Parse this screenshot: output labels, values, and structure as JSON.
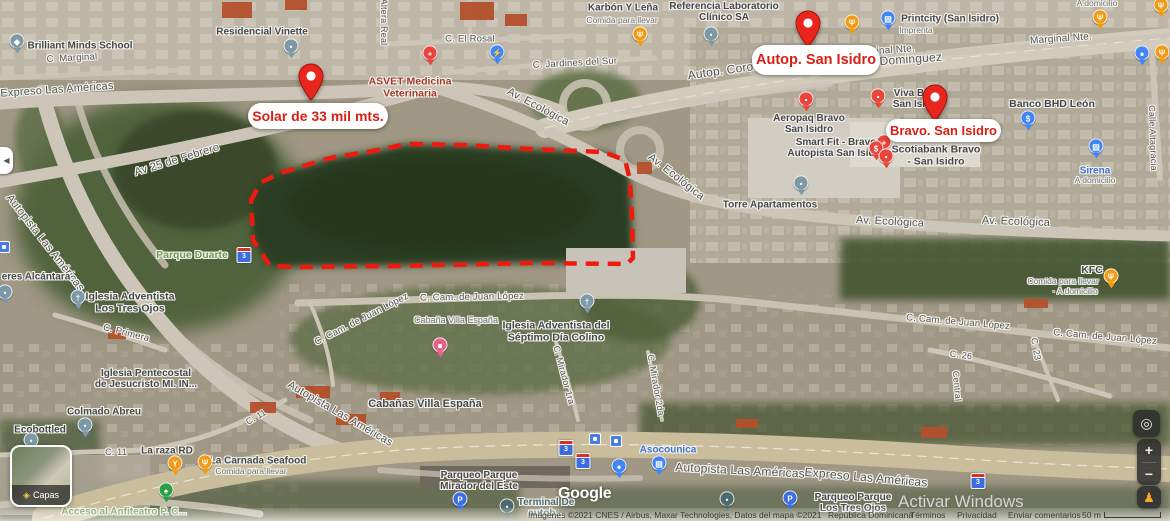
{
  "palette": {
    "marker_red": "#e8261d",
    "marker_text": "#d81f12",
    "red": "#e8453c",
    "orange": "#f09b13",
    "slate": "#7d99a5",
    "blue": "#4285f4",
    "parking": "#3b6fe0",
    "green": "#2e9e44",
    "pink": "#ea5f89",
    "teal": "#4d6a6d",
    "poi": "#45494d",
    "sub": "#6e747a",
    "red_poi": "#9f3a2a",
    "park": "#6f9c55",
    "blue_poi": "#3f6fd1",
    "transit": "#4b6a70",
    "street": "#53565a"
  },
  "custom_markers": [
    {
      "id": "solar",
      "label": "Solar de 33 mil mts.",
      "pin": {
        "x": 311,
        "y": 63
      },
      "box": {
        "x": 248,
        "y": 103,
        "w": 140,
        "h": 26,
        "fs": 14
      }
    },
    {
      "id": "autop-san-isidro",
      "label": "Autop. San Isidro",
      "pin": {
        "x": 808,
        "y": 10
      },
      "box": {
        "x": 752,
        "y": 45,
        "w": 128,
        "h": 30,
        "fs": 14.5
      }
    },
    {
      "id": "bravo-san-isidro",
      "label": "Bravo. San Isidro",
      "pin": {
        "x": 935,
        "y": 84
      },
      "box": {
        "x": 886,
        "y": 119,
        "w": 115,
        "h": 23,
        "fs": 13
      }
    }
  ],
  "parcel": {
    "points": "251,201 260,183 280,173 330,158 373,151 407,144 463,145 530,149 603,152 625,160 630,180 632,217 633,258 627,264 530,263 397,266 297,267 270,266 253,240",
    "color": "#ef1a0f"
  },
  "street_labels": [
    {
      "name": "street-c-marginal",
      "text": "C. Marginal",
      "x": 72,
      "y": 59,
      "r": -3,
      "size": 9.5
    },
    {
      "name": "street-expreso-las-americas",
      "text": "Expreso Las Américas",
      "x": 57,
      "y": 90,
      "r": -4,
      "size": 11
    },
    {
      "name": "street-av-25-de-febrero",
      "text": "Av 25 de Febrero",
      "x": 177,
      "y": 160,
      "r": -17,
      "size": 11
    },
    {
      "name": "street-altera-real",
      "text": "Altera Real",
      "x": 384,
      "y": 22,
      "r": 90,
      "size": 9
    },
    {
      "name": "street-c-el-rosal",
      "text": "C. El Rosal",
      "x": 470,
      "y": 40,
      "r": 0,
      "size": 9.5
    },
    {
      "name": "street-c-jardines-del-sur",
      "text": "C. Jardines del Sur",
      "x": 575,
      "y": 64,
      "r": -3,
      "size": 9.5
    },
    {
      "name": "street-marginal-nte-1",
      "text": "Marginal Nte.",
      "x": 884,
      "y": 51,
      "r": -4,
      "size": 10
    },
    {
      "name": "street-marginal-nte-2",
      "text": "Marginal Nte.",
      "x": 1061,
      "y": 39,
      "r": -4,
      "size": 10
    },
    {
      "name": "street-autop-coron",
      "text": "Autop. Coron",
      "x": 724,
      "y": 71,
      "r": -8,
      "size": 12
    },
    {
      "name": "street-dominguez",
      "text": "z Dominguez",
      "x": 906,
      "y": 60,
      "r": -4,
      "size": 12
    },
    {
      "name": "street-av-ecologica-1",
      "text": "Av. Ecológica",
      "x": 538,
      "y": 107,
      "r": 28,
      "size": 11
    },
    {
      "name": "street-av-ecologica-2",
      "text": "Av. Ecológica",
      "x": 676,
      "y": 177,
      "r": 38,
      "size": 11
    },
    {
      "name": "street-av-ecologica-3",
      "text": "Av. Ecológica",
      "x": 890,
      "y": 222,
      "r": 3,
      "size": 11
    },
    {
      "name": "street-av-ecologica-4",
      "text": "Av. Ecológica",
      "x": 1016,
      "y": 222,
      "r": 2,
      "size": 11
    },
    {
      "name": "street-autopista-left",
      "text": "Autopista Las Américas",
      "x": 45,
      "y": 243,
      "r": 52,
      "size": 11
    },
    {
      "name": "street-c-primera",
      "text": "C. Primera",
      "x": 126,
      "y": 334,
      "r": 14,
      "size": 9.5
    },
    {
      "name": "street-juan-lopez-1",
      "text": "C. Cam. de Juan López",
      "x": 472,
      "y": 298,
      "r": -1,
      "size": 9.5
    },
    {
      "name": "street-juan-lopez-2",
      "text": "C. Cam. de Juan López",
      "x": 362,
      "y": 320,
      "r": -27,
      "size": 9.5
    },
    {
      "name": "street-juan-lopez-3",
      "text": "C. Cam. de Juan López",
      "x": 958,
      "y": 323,
      "r": 5,
      "size": 9.5
    },
    {
      "name": "street-juan-lopez-4",
      "text": "C. Cam. de Juan López",
      "x": 1105,
      "y": 338,
      "r": 5,
      "size": 9.5
    },
    {
      "name": "street-c11-1",
      "text": "C. 11",
      "x": 116,
      "y": 452,
      "r": 0,
      "size": 9
    },
    {
      "name": "street-c11-2",
      "text": "C. 11",
      "x": 256,
      "y": 417,
      "r": -30,
      "size": 9
    },
    {
      "name": "street-c26",
      "text": "C. 26",
      "x": 961,
      "y": 355,
      "r": 8,
      "size": 9
    },
    {
      "name": "street-c23",
      "text": "C. 23",
      "x": 1036,
      "y": 349,
      "r": 80,
      "size": 9
    },
    {
      "name": "street-central",
      "text": "Central",
      "x": 957,
      "y": 386,
      "r": 85,
      "size": 9
    },
    {
      "name": "street-mirador-1ra",
      "text": "C. Mirador 1ra",
      "x": 564,
      "y": 375,
      "r": 75,
      "size": 9
    },
    {
      "name": "street-mirador-2da",
      "text": "C. Mirador 2da",
      "x": 656,
      "y": 385,
      "r": 80,
      "size": 9
    },
    {
      "name": "street-calle-altagracia",
      "text": "Calle Altagracia",
      "x": 1153,
      "y": 138,
      "r": 88,
      "size": 9
    },
    {
      "name": "street-autopista-diag",
      "text": "Autopista Las Américas",
      "x": 340,
      "y": 414,
      "r": 30,
      "size": 11
    },
    {
      "name": "street-autopista-bottom",
      "text": "Autopista Las Américas",
      "x": 740,
      "y": 471,
      "r": 3,
      "size": 12
    },
    {
      "name": "street-expreso-bottom",
      "text": "Expreso Las Américas",
      "x": 866,
      "y": 478,
      "r": 5,
      "size": 12
    }
  ],
  "poi_labels": [
    {
      "name": "label-brilliant-minds-school",
      "text": "Brilliant Minds School",
      "x": 80,
      "y": 46,
      "c": "poi",
      "size": 10
    },
    {
      "name": "label-residencial-vinette",
      "text": "Residencial Vinette",
      "x": 262,
      "y": 32,
      "c": "poi",
      "size": 10
    },
    {
      "name": "label-asvet",
      "text": "ASVET Medicina\nVeterinaria",
      "x": 410,
      "y": 88,
      "c": "red_poi",
      "size": 10.5
    },
    {
      "name": "label-karbon-y-lena",
      "text": "Karbón Y Leña",
      "x": 623,
      "y": 8,
      "c": "poi",
      "size": 10
    },
    {
      "name": "label-karbon-sub",
      "text": "Comida para llevar",
      "x": 622,
      "y": 21,
      "c": "sub",
      "size": 8.5
    },
    {
      "name": "label-referencia-laboratorio",
      "text": "Referencia Laboratorio\nClínico SA",
      "x": 724,
      "y": 12,
      "c": "poi",
      "size": 10
    },
    {
      "name": "label-printcity",
      "text": "Printcity (San Isidro)",
      "x": 950,
      "y": 19,
      "c": "poi",
      "size": 10
    },
    {
      "name": "label-printcity-sub",
      "text": "Imprenta",
      "x": 916,
      "y": 31,
      "c": "sub",
      "size": 8.5
    },
    {
      "name": "label-a-domicilio-top",
      "text": "A domicilio",
      "x": 1097,
      "y": 4,
      "c": "sub",
      "size": 8.5
    },
    {
      "name": "label-aeropaq",
      "text": "Aeropaq Bravo\nSan Isidro",
      "x": 809,
      "y": 124,
      "c": "poi",
      "size": 10
    },
    {
      "name": "label-smart-fit",
      "text": "Smart Fit - Bravo\nAutopista San Isidro",
      "x": 836,
      "y": 148,
      "c": "poi",
      "size": 10
    },
    {
      "name": "label-viva",
      "text": "Viva B\nSan Isi",
      "x": 909,
      "y": 99,
      "c": "poi",
      "size": 10
    },
    {
      "name": "label-scotiabank",
      "text": "Scotiabank Bravo\n- San Isidro",
      "x": 936,
      "y": 156,
      "c": "poi",
      "size": 10.5
    },
    {
      "name": "label-banco-bhd-leon",
      "text": "Banco BHD León",
      "x": 1052,
      "y": 105,
      "c": "poi",
      "size": 10.5
    },
    {
      "name": "label-sirena",
      "text": "Sirena",
      "x": 1095,
      "y": 171,
      "c": "blue_poi",
      "size": 10
    },
    {
      "name": "label-sirena-sub",
      "text": "A domicilio",
      "x": 1095,
      "y": 181,
      "c": "sub",
      "size": 8.5
    },
    {
      "name": "label-torre-apartamentos",
      "text": "Torre Apartamentos",
      "x": 770,
      "y": 205,
      "c": "poi",
      "size": 10
    },
    {
      "name": "label-parque-duarte",
      "text": "Parque Duarte",
      "x": 192,
      "y": 256,
      "c": "park",
      "size": 10.5
    },
    {
      "name": "label-iglesia-tres-ojos",
      "text": "Iglesia Adventista\nLos Tres Ojos",
      "x": 130,
      "y": 303,
      "c": "poi",
      "size": 10.5
    },
    {
      "name": "label-alcantara",
      "text": "eres Alcántara",
      "x": 36,
      "y": 277,
      "c": "poi",
      "size": 10
    },
    {
      "name": "label-iglesia-pentecostal",
      "text": "Iglesia Pentecostal\nde Jesucristo MI. IN...",
      "x": 146,
      "y": 379,
      "c": "poi",
      "size": 10
    },
    {
      "name": "label-colmado-abreu",
      "text": "Colmado Abreu",
      "x": 104,
      "y": 412,
      "c": "poi",
      "size": 10
    },
    {
      "name": "label-ecobottled",
      "text": "Ecobottled",
      "x": 40,
      "y": 430,
      "c": "poi",
      "size": 10
    },
    {
      "name": "label-la-raza-rd",
      "text": "La raza RD",
      "x": 167,
      "y": 451,
      "c": "poi",
      "size": 10
    },
    {
      "name": "label-la-carnada",
      "text": "La Carnada Seafood",
      "x": 258,
      "y": 461,
      "c": "poi",
      "size": 10
    },
    {
      "name": "label-la-carnada-sub",
      "text": "Comida para llevar",
      "x": 251,
      "y": 472,
      "c": "sub",
      "size": 8.5
    },
    {
      "name": "label-acceso-anfiteatro",
      "text": "Acceso al Anfiteatro P. C...",
      "x": 124,
      "y": 512,
      "c": "park",
      "size": 10
    },
    {
      "name": "label-cabana-small",
      "text": "Cabaña Villa España",
      "x": 456,
      "y": 320,
      "c": "sub",
      "size": 9
    },
    {
      "name": "label-cabanas-villa-espana",
      "text": "Cabañas Villa España",
      "x": 425,
      "y": 404,
      "c": "poi",
      "size": 11
    },
    {
      "name": "label-iglesia-septimo-dia",
      "text": "Iglesia Adventista del\nSéptimo Día Colino",
      "x": 556,
      "y": 332,
      "c": "poi",
      "size": 10.5
    },
    {
      "name": "label-kfc",
      "text": "KFC",
      "x": 1092,
      "y": 271,
      "c": "poi",
      "size": 10.5
    },
    {
      "name": "label-kfc-sub1",
      "text": "Comida para llevar",
      "x": 1063,
      "y": 282,
      "c": "sub",
      "size": 8.5
    },
    {
      "name": "label-kfc-sub2",
      "text": "· A domicilio",
      "x": 1075,
      "y": 292,
      "c": "sub",
      "size": 8.5
    },
    {
      "name": "label-asocounica",
      "text": "Asocounica",
      "x": 668,
      "y": 450,
      "c": "blue_poi",
      "size": 10
    },
    {
      "name": "label-parqueo-mirador-este",
      "text": "Parqueo Parque\nMirador del Este",
      "x": 479,
      "y": 481,
      "c": "poi",
      "size": 10
    },
    {
      "name": "label-terminal",
      "text": "Terminal De\nautob...",
      "x": 546,
      "y": 508,
      "c": "transit",
      "size": 10
    },
    {
      "name": "label-parqueo-tres-ojos",
      "text": "Parqueo Parque\nLos Tres Ojos",
      "x": 853,
      "y": 503,
      "c": "poi",
      "size": 10
    }
  ],
  "poi_pins": [
    {
      "name": "school-pin",
      "x": 17,
      "y": 45,
      "color": "slate",
      "glyph": "◆"
    },
    {
      "name": "residencial-pin",
      "x": 291,
      "y": 50,
      "color": "slate",
      "glyph": "•"
    },
    {
      "name": "veterinary-pin",
      "x": 430,
      "y": 57,
      "color": "red",
      "glyph": "+"
    },
    {
      "name": "ev-charging-pin",
      "x": 497,
      "y": 56,
      "color": "blue",
      "glyph": "⚡"
    },
    {
      "name": "restaurant-pin",
      "x": 640,
      "y": 38,
      "color": "orange",
      "glyph": "Ψ"
    },
    {
      "name": "laboratory-pin",
      "x": 711,
      "y": 38,
      "color": "slate",
      "glyph": "•"
    },
    {
      "name": "restaurant-pin",
      "x": 852,
      "y": 26,
      "color": "orange",
      "glyph": "Ψ"
    },
    {
      "name": "printer-pin",
      "x": 888,
      "y": 22,
      "color": "blue",
      "glyph": "▤"
    },
    {
      "name": "restaurant-pin",
      "x": 1100,
      "y": 21,
      "color": "orange",
      "glyph": "Ψ"
    },
    {
      "name": "restaurant-pin",
      "x": 1161,
      "y": 9,
      "color": "orange",
      "glyph": "Ψ"
    },
    {
      "name": "restaurant-pin",
      "x": 1162,
      "y": 56,
      "color": "orange",
      "glyph": "Ψ"
    },
    {
      "name": "lock-pin",
      "x": 1142,
      "y": 57,
      "color": "blue",
      "glyph": "●"
    },
    {
      "name": "aeropaq-pin",
      "x": 806,
      "y": 103,
      "color": "red",
      "glyph": "▪"
    },
    {
      "name": "viva-pet-pin",
      "x": 878,
      "y": 100,
      "color": "red",
      "glyph": "▪"
    },
    {
      "name": "smart-fit-pin",
      "x": 884,
      "y": 146,
      "color": "red",
      "glyph": "+"
    },
    {
      "name": "scotiabank-pin",
      "x": 876,
      "y": 152,
      "color": "red",
      "glyph": "$"
    },
    {
      "name": "store-pin",
      "x": 886,
      "y": 160,
      "color": "red",
      "glyph": "▪"
    },
    {
      "name": "bank-pin",
      "x": 1028,
      "y": 122,
      "color": "blue",
      "glyph": "$"
    },
    {
      "name": "supermarket-cart-pin",
      "x": 1096,
      "y": 150,
      "color": "blue",
      "glyph": "▤"
    },
    {
      "name": "torre-pin",
      "x": 801,
      "y": 187,
      "color": "slate",
      "glyph": "•"
    },
    {
      "name": "church-pin",
      "x": 78,
      "y": 301,
      "color": "slate",
      "glyph": "†"
    },
    {
      "name": "alcantara-pin",
      "x": 5,
      "y": 296,
      "color": "slate",
      "glyph": "•"
    },
    {
      "name": "church-pin",
      "x": 587,
      "y": 305,
      "color": "slate",
      "glyph": "†"
    },
    {
      "name": "lodging-pin",
      "x": 440,
      "y": 349,
      "color": "pink",
      "glyph": "■"
    },
    {
      "name": "colmado-pin",
      "x": 85,
      "y": 429,
      "color": "slate",
      "glyph": "•"
    },
    {
      "name": "ecobottled-pin",
      "x": 31,
      "y": 444,
      "color": "slate",
      "glyph": "•"
    },
    {
      "name": "bar-pin",
      "x": 175,
      "y": 467,
      "color": "orange",
      "glyph": "Y"
    },
    {
      "name": "restaurant-pin",
      "x": 205,
      "y": 466,
      "color": "orange",
      "glyph": "Ψ"
    },
    {
      "name": "tree-pin",
      "x": 166,
      "y": 494,
      "color": "green",
      "glyph": "♠"
    },
    {
      "name": "restaurant-pin",
      "x": 1111,
      "y": 280,
      "color": "orange",
      "glyph": "Ψ"
    },
    {
      "name": "cart-pin",
      "x": 659,
      "y": 467,
      "color": "blue",
      "glyph": "▤"
    },
    {
      "name": "lock-pin",
      "x": 619,
      "y": 470,
      "color": "blue",
      "glyph": "●"
    },
    {
      "name": "parking-pin",
      "x": 460,
      "y": 503,
      "color": "parking",
      "glyph": "P"
    },
    {
      "name": "parking-pin",
      "x": 790,
      "y": 502,
      "color": "parking",
      "glyph": "P"
    },
    {
      "name": "terminal-pin",
      "x": 507,
      "y": 510,
      "color": "teal",
      "glyph": "•"
    },
    {
      "name": "transit-pin",
      "x": 727,
      "y": 503,
      "color": "teal",
      "glyph": "•"
    }
  ],
  "route_shields": [
    {
      "label": "3",
      "x": 244,
      "y": 255
    },
    {
      "label": "3",
      "x": 566,
      "y": 448
    },
    {
      "label": "3",
      "x": 583,
      "y": 461
    },
    {
      "label": "3",
      "x": 978,
      "y": 481
    }
  ],
  "transit_icons": [
    {
      "x": 595,
      "y": 439
    },
    {
      "x": 616,
      "y": 441
    },
    {
      "x": 4,
      "y": 247
    }
  ],
  "controls": {
    "layers_label": "Capas",
    "zoom_in": "+",
    "zoom_out": "−"
  },
  "icons": {
    "collapse": "◀",
    "locate": "◎",
    "layers_diamond": "◈",
    "pegman": "♟"
  },
  "google_logo": "Google",
  "watermark": "Activar Windows",
  "attribution": {
    "imagery": "Imágenes ©2021 CNES / Airbus, Maxar Technologies, Datos del mapa ©2021",
    "region": "República Dominicana",
    "terms": "Términos",
    "privacy": "Privacidad",
    "feedback": "Enviar comentarios",
    "scale": "50 m"
  }
}
